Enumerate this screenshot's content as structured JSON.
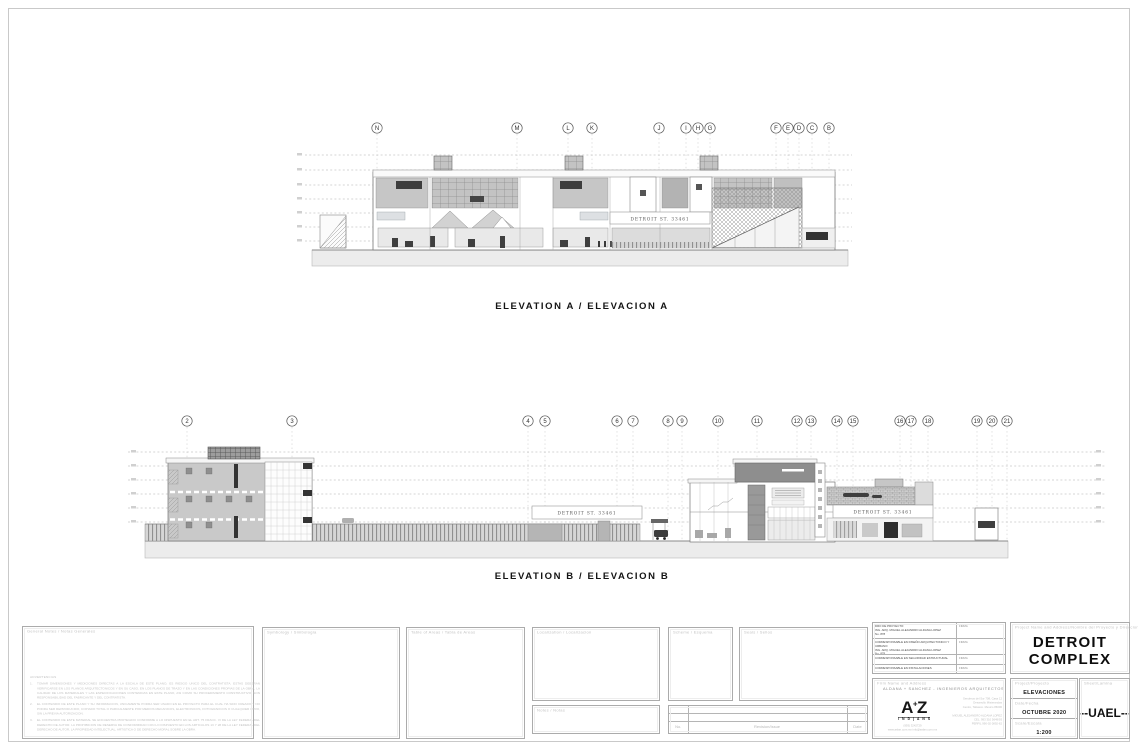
{
  "elevation_a": {
    "title": "ELEVATION  A  /  ELEVACION  A",
    "sign": "DETROIT ST. 33461",
    "grids": [
      {
        "label": "N",
        "x": 377
      },
      {
        "label": "M",
        "x": 517
      },
      {
        "label": "L",
        "x": 568
      },
      {
        "label": "K",
        "x": 592
      },
      {
        "label": "J",
        "x": 659
      },
      {
        "label": "I",
        "x": 686
      },
      {
        "label": "H",
        "x": 698
      },
      {
        "label": "G",
        "x": 710
      },
      {
        "label": "F",
        "x": 776
      },
      {
        "label": "E",
        "x": 788
      },
      {
        "label": "D",
        "x": 799
      },
      {
        "label": "C",
        "x": 812
      },
      {
        "label": "B",
        "x": 829
      }
    ]
  },
  "elevation_b": {
    "title": "ELEVATION  B  /  ELEVACION  B",
    "sign_left": "DETROIT ST. 33461",
    "sign_right": "DETROIT ST. 33461",
    "grids": [
      {
        "label": "2",
        "x": 187
      },
      {
        "label": "3",
        "x": 292
      },
      {
        "label": "4",
        "x": 528
      },
      {
        "label": "5",
        "x": 545
      },
      {
        "label": "6",
        "x": 617
      },
      {
        "label": "7",
        "x": 633
      },
      {
        "label": "8",
        "x": 668
      },
      {
        "label": "9",
        "x": 682
      },
      {
        "label": "10",
        "x": 718
      },
      {
        "label": "11",
        "x": 757
      },
      {
        "label": "12",
        "x": 797
      },
      {
        "label": "13",
        "x": 811
      },
      {
        "label": "14",
        "x": 837
      },
      {
        "label": "15",
        "x": 853
      },
      {
        "label": "16",
        "x": 900
      },
      {
        "label": "17",
        "x": 911
      },
      {
        "label": "18",
        "x": 928
      },
      {
        "label": "19",
        "x": 977
      },
      {
        "label": "20",
        "x": 992
      },
      {
        "label": "21",
        "x": 1007
      }
    ]
  },
  "panels": {
    "general_notes": {
      "header": "General  Notes  /  Notas  Generales",
      "warning_title": "ADVERTENCIAS",
      "notes": [
        "TOMAR DIMENSIONES Y MEDICIONES DIRECTAS A LA ESCALA DE ESTE PLANO, ES RIESGO UNICO DEL CONTRATISTA. ESTAS DEBERAN VERIFICARSE EN LOS PLANOS ARQUITECTONICOS Y EN SU CASO, EN LOS PLANOS DE TRAZO Y EN LAS CONDICIONES PROPIAS DE LA OBRA. LA CALIDAD DE LOS MATERIALES Y LAS ESPECIFICACIONES CONTENIDAS EN ESTE PLANO, ASI COMO SU PROCEDIMIENTO CONSTRUCTIVO, SON RESPONSABILIDAD DEL FABRICANTE Y DEL CONTRATISTA.",
        "EL CONTENIDO DE ESTE PLANO Y SU INFORMACION, UNICAMENTE PODRA SER USADO EN EL PROYECTO PARA EL CUAL HA SIDO CREADO Y NO PODRA SER REPRODUCIDO, COPIADO TOTAL O PARCIALMENTE POR MEDIOS MECANICOS, ELECTRONICOS, FOTOGRAFICOS O CUALQUIER OTRO, SIN LA PREVIA AUTORIZACION.",
        "EL CONTENIDO DE ESTE MATERIAL SE ENCUENTRA PROTEGIDO CONFORME A LO DISPUESTO EN EL ART. 75 FRACC. VI DE LA LEY FEDERAL DEL DERECHO DE AUTOR. LA PROHIBICION DE RESERVA DE CONFORMIDAD CON LO DISPUESTO EN LOS ARTICULOS 13 Y 28 DE LA LEY FEDERAL DEL DERECHO DE AUTOR, LA PROPIEDAD INTELECTUAL, ARTISTICA O DE DERECHO MORAL SOBRE LA OBRA."
      ]
    },
    "symbology": {
      "header": "Symbology  /  Simbologia"
    },
    "areas": {
      "header": "Table of Areas  /  Tabla de Areas"
    },
    "localization": {
      "header": "Localization  /  Localizacion"
    },
    "notes_small": {
      "header": "Notes  /  Notas"
    },
    "scheme": {
      "header": "Scheme  /  Esquema"
    },
    "seals": {
      "header": "Seals  /  Sellos"
    },
    "revision": {
      "no_label": "No.",
      "issue_label": "Revision/Issue",
      "date_label": "Date"
    }
  },
  "signatures": {
    "rows": [
      {
        "name": "DRO DE PROYECTO:\nING. ARQ. MIGUEL ALEJANDRO ALDANA LOPEZ\nNo. 878",
        "sign": "FIRMA"
      },
      {
        "name": "CORRESPONSABLE EN DISEÑO ARQUITECTONICO Y URBANO:\nING. ARQ. MIGUEL ALEJANDRO ALDANA LOPEZ\nNo. 878",
        "sign": "FIRMA"
      },
      {
        "name": "CORRESPONSABLE EN SEGURIDAD ESTRUCTURAL",
        "sign": "FIRMA"
      },
      {
        "name": "CORRESPONSABLE EN INSTALACIONES",
        "sign": "FIRMA"
      }
    ]
  },
  "firm": {
    "header": "Firm  Name  and  Address",
    "name": "ALDANA  +  SANCHEZ   -   INGENIEROS  ARQUITECTOS",
    "logo_main": "A",
    "logo_plus": "+",
    "logo_z": "Z",
    "logo_sub": "I N D | A N S",
    "phone_web": "(993) 3242729\nwww.aslan.com.mx  info@aslan.com.mx",
    "contact": "Senderos del Sur 708, Casa 12\nDesarrollo Misterandas\nCentro, Tabasco. Mexico 86000\n\nMIGUEL ALEJANDRO ALDANA LOPEZ\nCEL. 993 310 5649/93\nPERFIL 990-02 0892-62"
  },
  "titleblock": {
    "project_header": "Project  Name  and  Address/Nombre  del  Proyecto  y  Direccion",
    "project_name": "DETROIT\nCOMPLEX",
    "project_label": "Project/Proyecto",
    "project_value": "ELEVACIONES",
    "date_label": "Date/Fecha",
    "date_value": "OCTUBRE 2020",
    "scale_label": "Scale/Escala",
    "scale_value": "1:200",
    "sheet_label": "Sheet/Lamina",
    "sheet_value": "--UAEL--"
  }
}
